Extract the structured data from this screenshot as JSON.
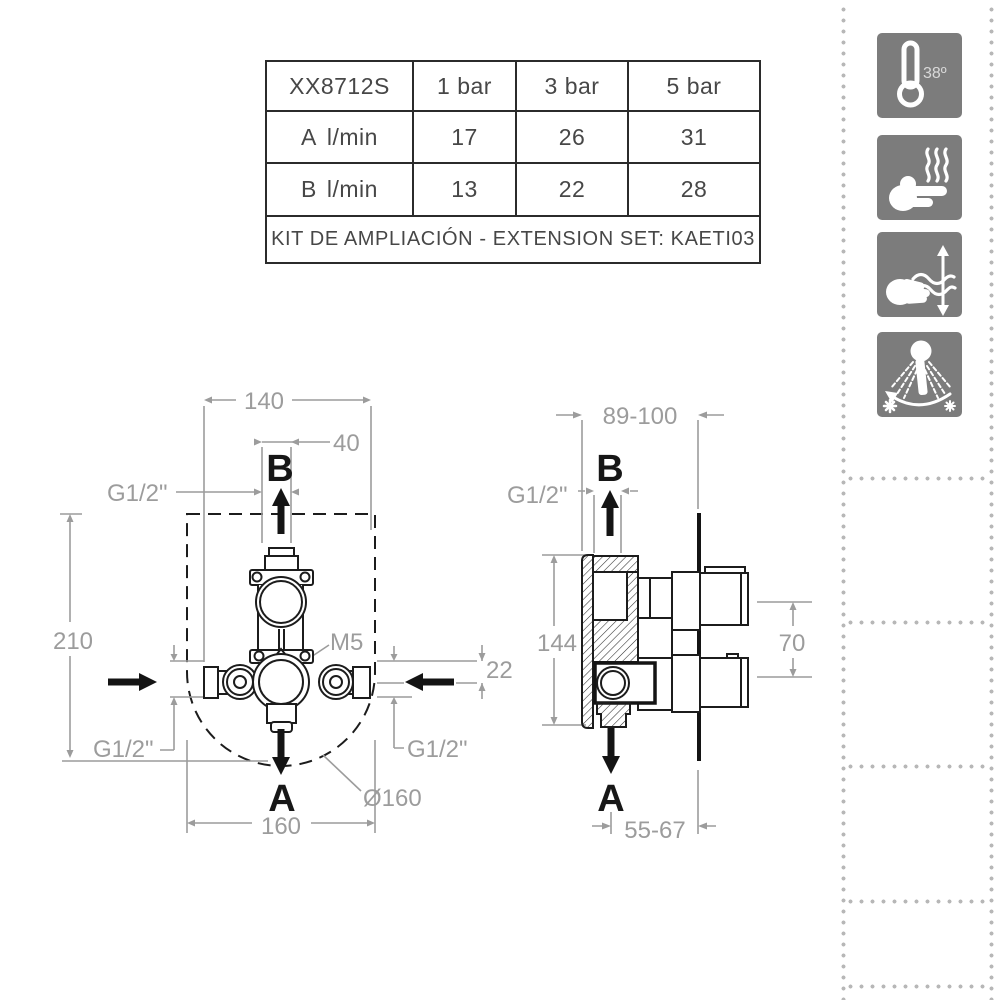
{
  "table": {
    "model": "XX8712S",
    "col_headers": [
      "1 bar",
      "3 bar",
      "5 bar"
    ],
    "rows": [
      {
        "name": "A",
        "unit": "l/min",
        "values": [
          "17",
          "26",
          "31"
        ]
      },
      {
        "name": "B",
        "unit": "l/min",
        "values": [
          "13",
          "22",
          "28"
        ]
      }
    ],
    "footer": "KIT DE AMPLIACIÓN - EXTENSION SET: KAETI03"
  },
  "icons": {
    "thermostat_temp": "38º"
  },
  "front_view": {
    "label_b": "B",
    "label_a": "A",
    "dim_width_top": "140",
    "dim_offset_top": "40",
    "thread_top": "G1/2\"",
    "dim_height": "210",
    "screw": "M5",
    "dim_side": "22",
    "thread_bottom_left": "G1/2\"",
    "thread_bottom_right": "G1/2\"",
    "dim_diameter": "Ø160",
    "dim_width_bottom": "160"
  },
  "side_view": {
    "label_b": "B",
    "label_a": "A",
    "dim_depth": "89-100",
    "thread_top": "G1/2\"",
    "dim_height": "144",
    "dim_handles": "70",
    "dim_outlet_depth": "55-67"
  }
}
